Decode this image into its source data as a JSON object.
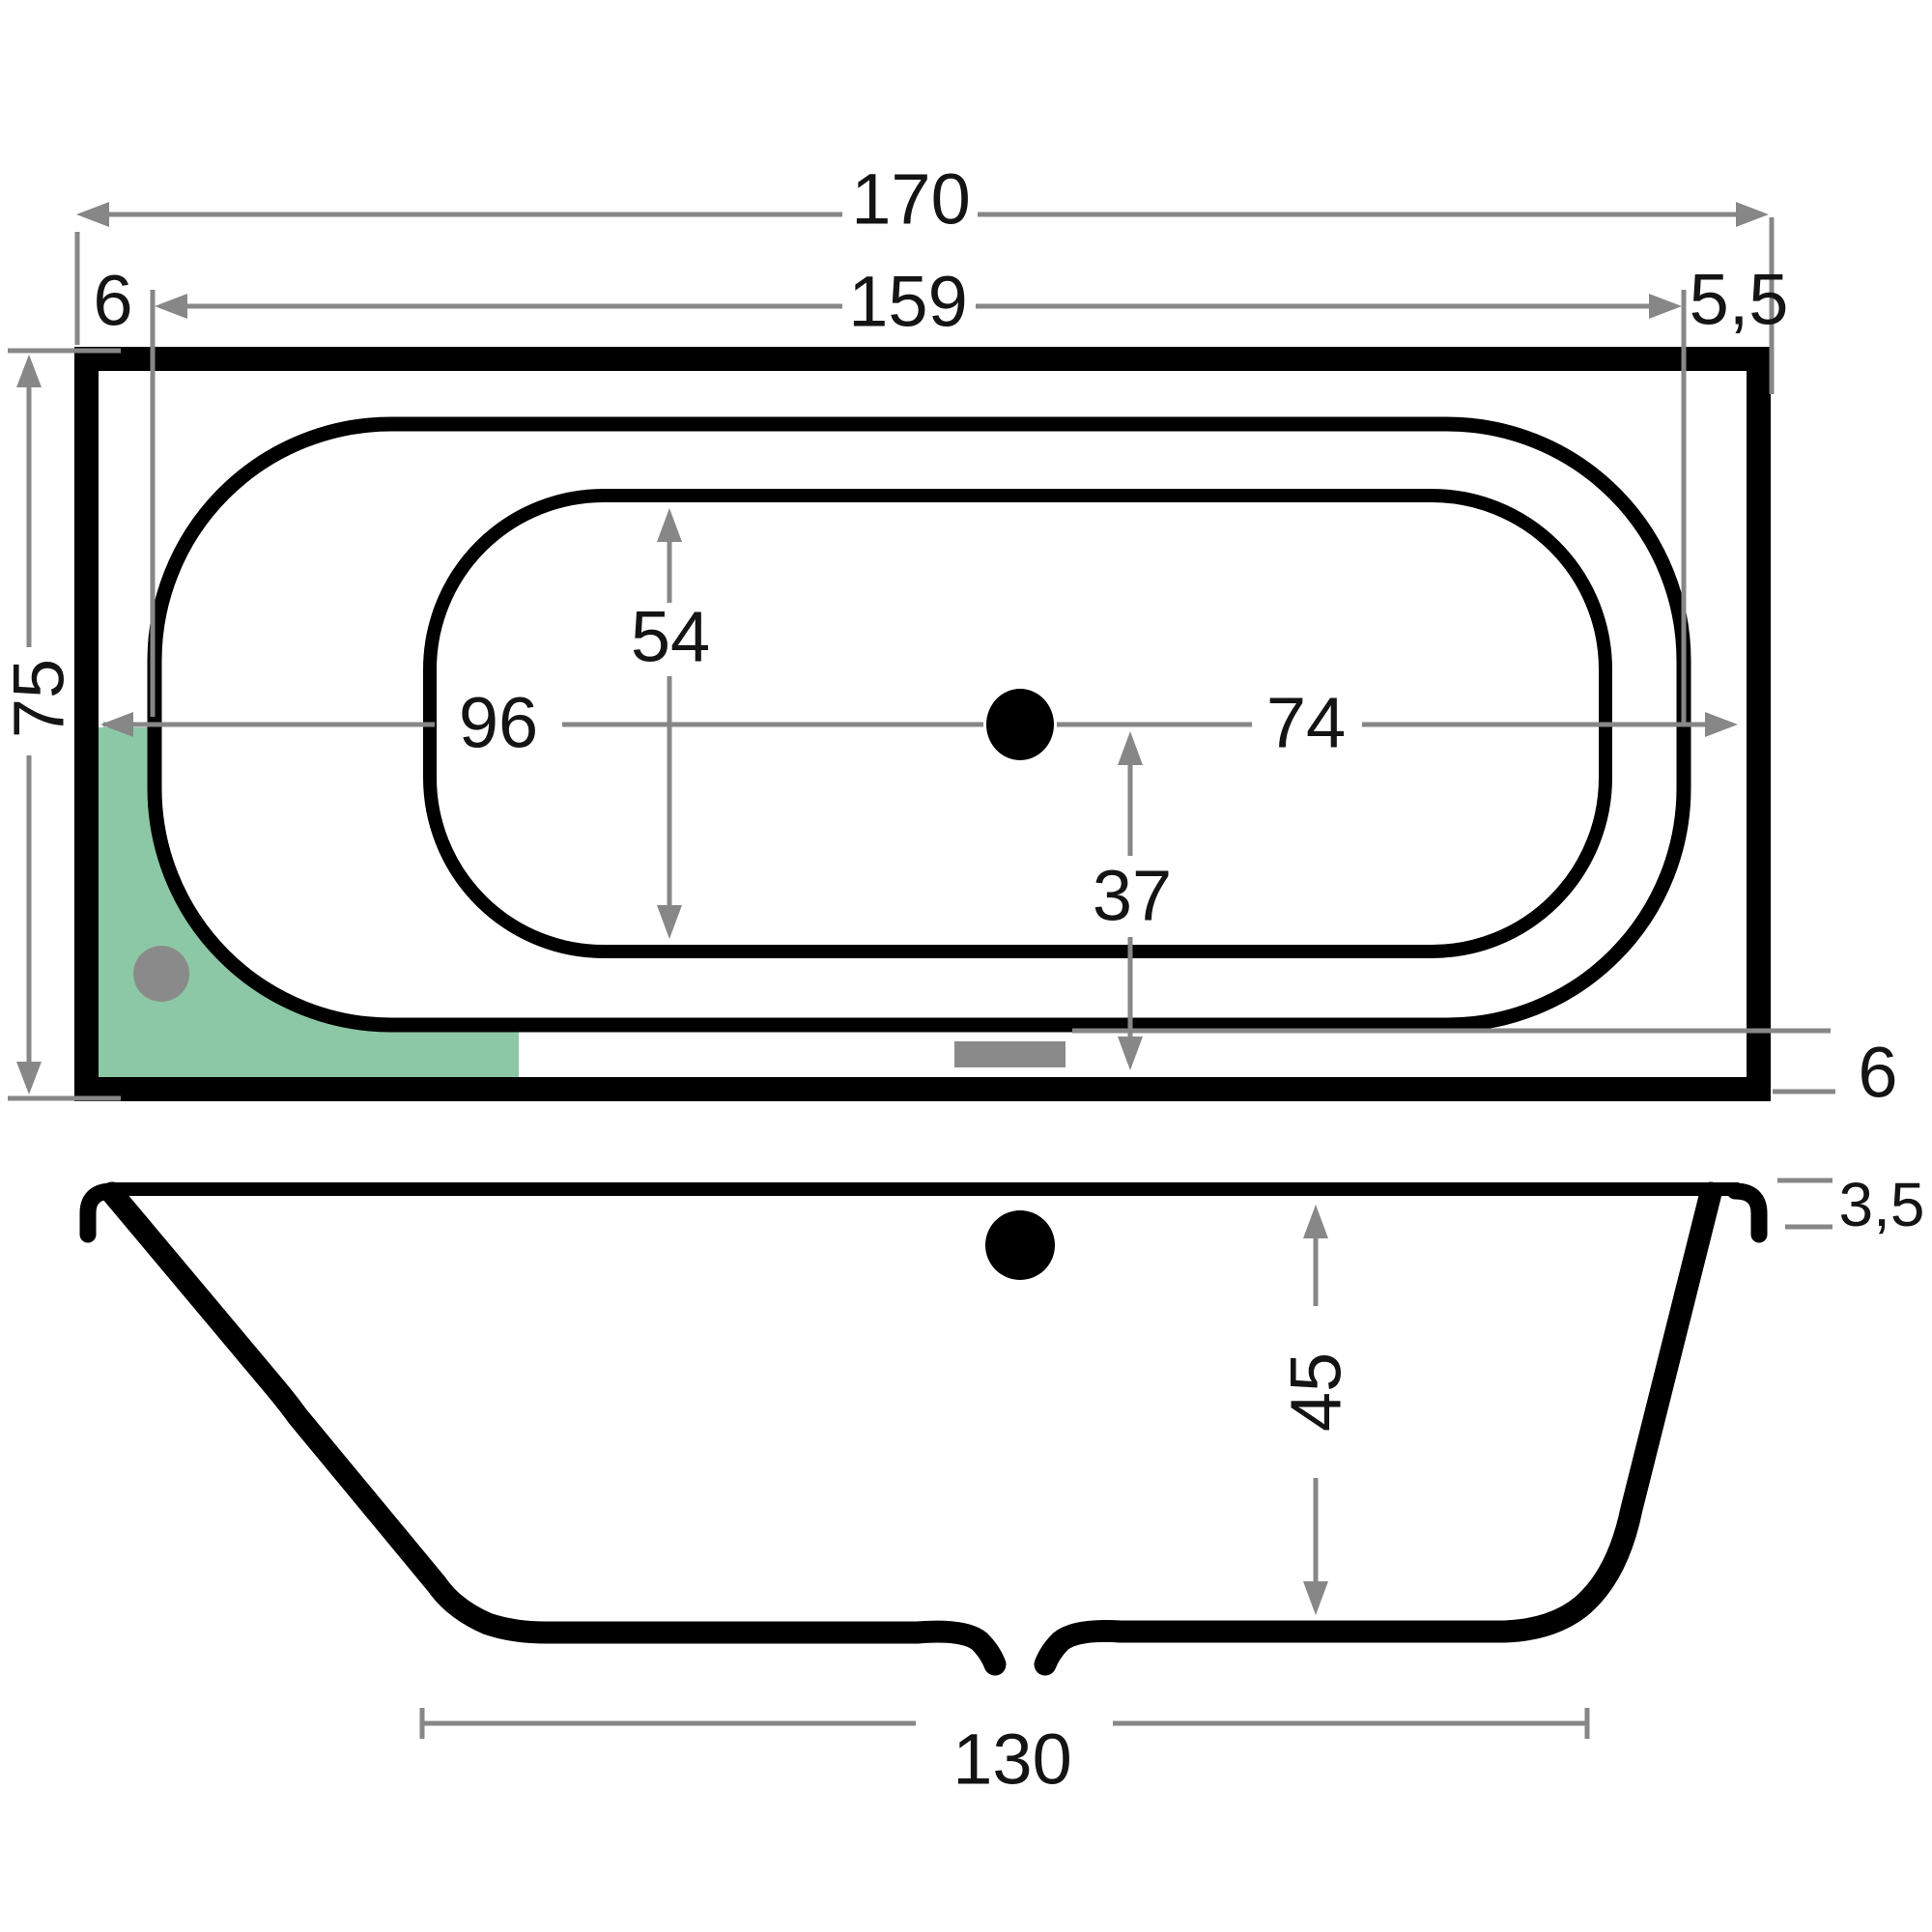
{
  "title": "Bathtub technical dimension drawing (top view and side section)",
  "colors": {
    "dim": "#878787",
    "ink": "#141414",
    "highlight": "#8cc8a5",
    "fixture": "#8a8a8a",
    "background": "#ffffff"
  },
  "top_view": {
    "length_overall": "170",
    "length_inner": "159",
    "rim_left": "6",
    "rim_right": "5,5",
    "width_overall": "75",
    "floor_width": "54",
    "drain_to_left_edge": "96",
    "drain_to_right_edge": "74",
    "drain_to_front_edge": "37",
    "rim_bottom": "6"
  },
  "side_view": {
    "rim_drop": "3,5",
    "depth": "45",
    "floor_length": "130"
  },
  "icons": {
    "drain_top": "drain-dot",
    "drain_side": "drain-dot",
    "jet": "jet-dot",
    "overflow": "overflow-bar",
    "seat_zone": "highlight-corner-zone"
  }
}
